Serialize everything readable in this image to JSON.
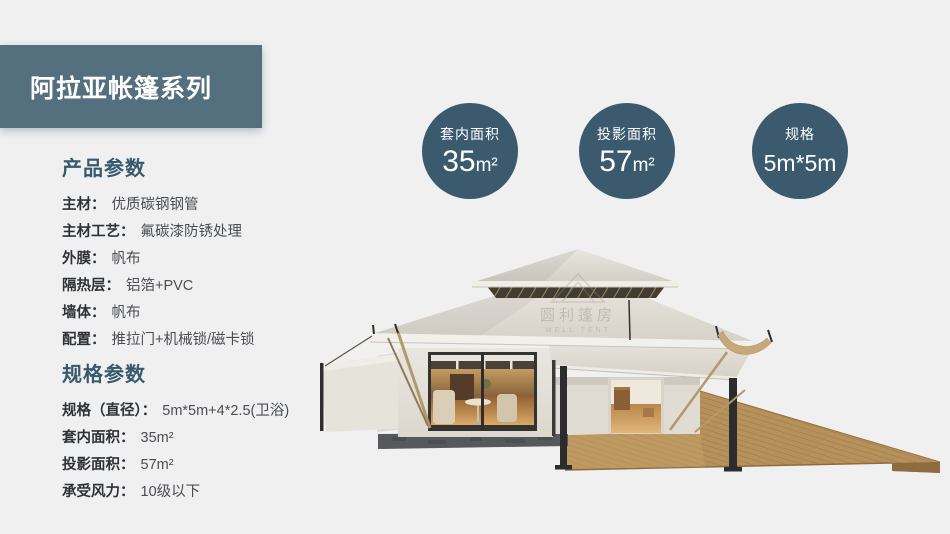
{
  "header": {
    "title": "阿拉亚帐篷系列"
  },
  "badges": [
    {
      "label": "套内面积",
      "value": "35",
      "unit": "m²"
    },
    {
      "label": "投影面积",
      "value": "57",
      "unit": "m²"
    },
    {
      "label": "规格",
      "value": "5m*5m",
      "unit": ""
    }
  ],
  "product_params": {
    "heading": "产品参数",
    "rows": [
      {
        "label": "主材：",
        "value": "优质碳钢钢管"
      },
      {
        "label": "主材工艺：",
        "value": "氟碳漆防锈处理"
      },
      {
        "label": "外膜：",
        "value": "帆布"
      },
      {
        "label": "隔热层：",
        "value": "铝箔+PVC"
      },
      {
        "label": "墙体：",
        "value": "帆布"
      },
      {
        "label": "配置：",
        "value": "推拉门+机械锁/磁卡锁"
      }
    ]
  },
  "spec_params": {
    "heading": "规格参数",
    "rows": [
      {
        "label": "规格（直径）：",
        "value": "5m*5m+4*2.5(卫浴)"
      },
      {
        "label": "套内面积：",
        "value": "35m²"
      },
      {
        "label": "投影面积：",
        "value": "57m²"
      },
      {
        "label": "承受风力：",
        "value": "10级以下"
      }
    ]
  },
  "watermark": {
    "cn": "圆利篷房",
    "en": "WELL TENT"
  },
  "colors": {
    "page_bg": "#f0f0f1",
    "banner_bg": "#546f7e",
    "badge_bg": "#3b5a6e",
    "heading": "#36596d",
    "roof_cream": "#dedbd3",
    "deck_wood": "#b6915b"
  }
}
